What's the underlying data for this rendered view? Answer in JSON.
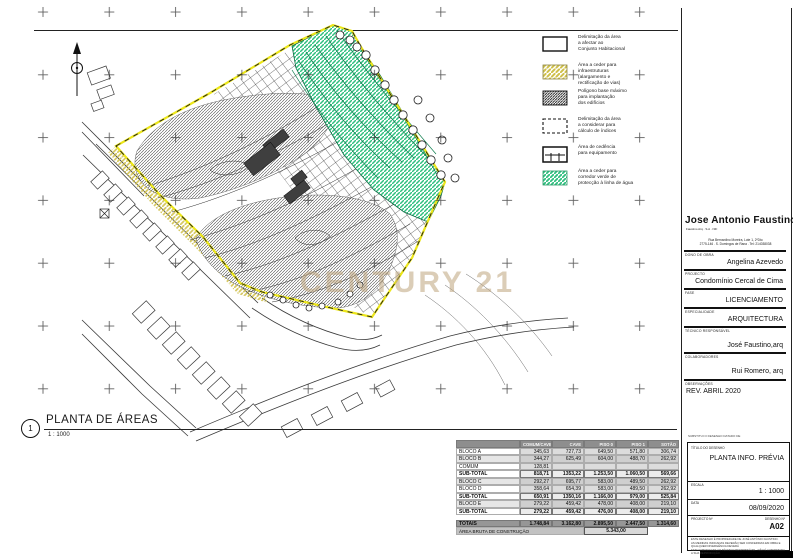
{
  "drawing": {
    "title": "PLANTA DE ÁREAS",
    "number": "1",
    "scale": "1 : 1000",
    "watermark": "CENTURY 21"
  },
  "colors": {
    "green_corridor": "#2fbf7f",
    "yellow_cession": "#cfc04a",
    "boundary_yellow": "#ece619",
    "watermark_tan": "#bda47c",
    "table_header_gray": "#8e8e8e"
  },
  "legend": {
    "items": [
      {
        "swatch": "plain",
        "lines": [
          "Delimitação da área",
          "a afectar ao",
          "Conjunto Habitacional"
        ]
      },
      {
        "swatch": "yellow",
        "lines": [
          "Área a ceder para",
          "infraestruturas",
          "(alargamento e",
          "rectificação de vias)"
        ]
      },
      {
        "swatch": "dark",
        "lines": [
          "Polígono base máximo",
          "para implantação",
          "dos edifícios"
        ]
      },
      {
        "swatch": "dashed",
        "lines": [
          "Delimitação da área",
          "a considerar para",
          "cálculo de índices"
        ]
      },
      {
        "swatch": "equip",
        "lines": [
          "Área de cedência",
          "para equipamento"
        ]
      },
      {
        "swatch": "green",
        "lines": [
          "Área a ceder para",
          "corredor verde de",
          "protecção à linha de água"
        ]
      }
    ]
  },
  "titleblock": {
    "name": "Jose Antonio Faustino",
    "subtitle": "Faustino Arq . S.A . NIF",
    "address_lines": [
      "Rua Bernardino Moreira, Lote 1, 2ºDto",
      "2775-146 . S. Domingos de Rana . Tel: 214038038"
    ],
    "sections": [
      {
        "label": "DONO DE OBRA",
        "value": "Angelina Azevedo"
      },
      {
        "label": "PROJECTO",
        "value": "Condomínio Cercal de Cima"
      },
      {
        "label": "FASE",
        "value": "LICENCIAMENTO"
      },
      {
        "label": "ESPECIALIDADE",
        "value": "ARQUITECTURA"
      },
      {
        "label": "TÉCNICO RESPONSÁVEL",
        "value": "José Faustino,arq"
      },
      {
        "label": "COLABORADORES",
        "value": "Rui Romero, arq"
      },
      {
        "label": "OBSERVAÇÕES",
        "value": "REV.    ABRIL 2020"
      }
    ]
  },
  "infoblock": {
    "note": "SUBSTITUI O DESENHO DATADO DE",
    "title_label": "TÍTULO DO DESENHO",
    "title": "PLANTA INFO. PRÉVIA",
    "scale_label": "ESCALA",
    "scale": "1 : 1000",
    "date_label": "DATA",
    "date": "08/09/2020",
    "project_no_label": "PROJECTO Nº",
    "drawing_no_label": "DESENHO Nº",
    "drawing_no": "A02",
    "disclaimer": [
      "ESTE DESENHO É PROPRIEDADE DE JOSÉ ANTÓNIO FAUSTINO.",
      "AS MEDIDAS INDICADAS DEVERÃO SER CONFERIDAS EM OBRA E QUALQUER DIVERGÊNCIA DEVERÁ",
      "SER COMUNICADA AO TÉCNICO RESPONSÁVEL. NÃO É AUTORIZADA A SUA REPRODUÇÃO."
    ]
  },
  "table": {
    "headers": [
      "",
      "COMUM/CAVE",
      "CAVE",
      "PISO 0",
      "PISO 1",
      "SOTÃO"
    ],
    "rows": [
      {
        "label": "BLOCO A",
        "style": "data",
        "values": [
          "345,63",
          "727,73",
          "649,50",
          "571,80",
          "306,74"
        ]
      },
      {
        "label": "BLOCO B",
        "style": "alt",
        "values": [
          "344,27",
          "625,49",
          "604,00",
          "488,70",
          "262,92"
        ]
      },
      {
        "label": "COMUM",
        "style": "data",
        "values": [
          "128,81",
          "",
          "",
          "",
          ""
        ]
      },
      {
        "label": "SUB-TOTAL",
        "style": "subtotal",
        "values": [
          "818,71",
          "1353,22",
          "1.253,50",
          "1.060,50",
          "569,66"
        ]
      },
      {
        "label": "BLOCO C",
        "style": "alt",
        "values": [
          "292,27",
          "695,77",
          "583,00",
          "489,50",
          "262,92"
        ]
      },
      {
        "label": "BLOCO D",
        "style": "data",
        "values": [
          "358,64",
          "654,39",
          "583,00",
          "489,50",
          "262,92"
        ]
      },
      {
        "label": "SUB-TOTAL",
        "style": "subtotal",
        "values": [
          "650,91",
          "1350,16",
          "1.166,00",
          "979,00",
          "525,84"
        ]
      },
      {
        "label": "BLOCO E",
        "style": "alt",
        "values": [
          "279,22",
          "459,42",
          "478,00",
          "408,00",
          "219,10"
        ]
      },
      {
        "label": "SUB-TOTAL",
        "style": "subtotal",
        "values": [
          "279,22",
          "459,42",
          "476,00",
          "408,00",
          "219,10"
        ]
      }
    ],
    "totals": {
      "label": "TOTAIS",
      "values": [
        "1.748,84",
        "3.162,80",
        "2.895,50",
        "2.447,50",
        "1.314,60"
      ]
    },
    "gross": {
      "label": "ÁREA BRUTA DE CONSTRUÇÃO",
      "value": "5.343,00"
    }
  }
}
